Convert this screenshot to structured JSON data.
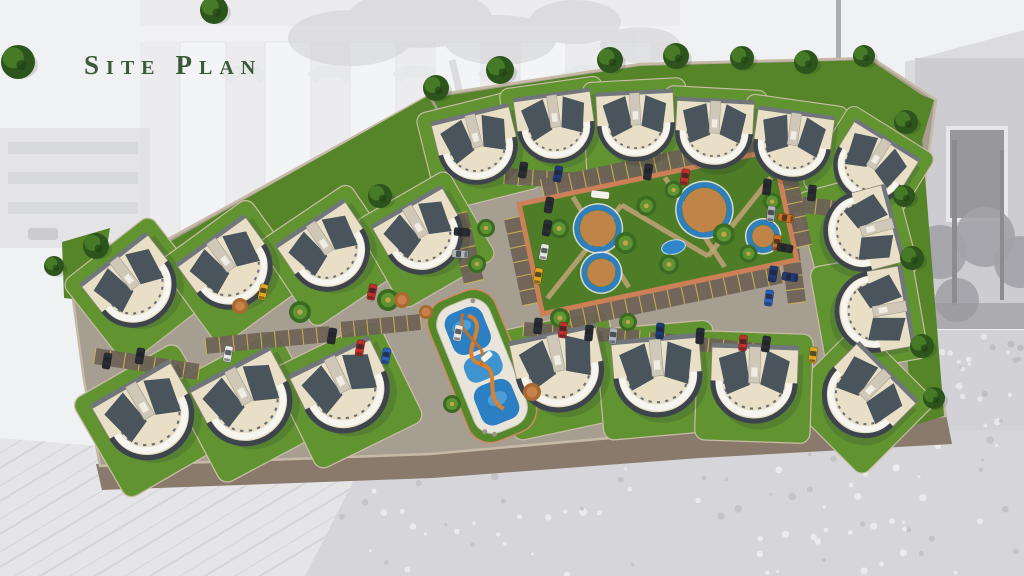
{
  "slide": {
    "title_full": "Site Plan",
    "title_s1": "S",
    "title_s2": "ITE",
    "title_s3": "P",
    "title_s4": "LAN",
    "title_color": "#3b5a39"
  },
  "palette": {
    "pavement": "#a79e92",
    "curb": "#8a7a6c",
    "site_edge": "#c6b9a6",
    "grass": "#558429",
    "grass_pad": "#619331",
    "grass_edge": "#c9bda8",
    "roof_cream": "#e9dfc6",
    "roof_dark": "#4a545c",
    "roof_spine": "#cfc8b8",
    "villa_outline": "#8a8276",
    "front_white": "#f7f5ef",
    "front_dark": "#3d444b",
    "stall": "#6e6156",
    "stall_line": "#d2b855",
    "terracotta": "#cc8057",
    "court_green": "#4f7c27",
    "path_tan": "#c2a377",
    "ring_blue": "#2e7ec2",
    "ring_center": "#c08448",
    "pond_blue": "#2f86c8",
    "pool_blue": "#2b7fc2",
    "pool_blue_light": "#58a5da",
    "deck_white": "#e9e5da",
    "slide_orange": "#d8812f",
    "tree_dark": "#2d541c",
    "tree_light": "#477a27",
    "palm_dark": "#3a6b21",
    "palm_light": "#5d9431",
    "palm_center": "#c9a24e",
    "bush_orange": "#a9692f",
    "bush_orange_light": "#c6824a",
    "car_colors": {
      "red": "#c03028",
      "navy": "#1f3a7a",
      "blue": "#2c5fc0",
      "yellow": "#e0a820",
      "white": "#e8e8e8",
      "dark": "#2a2d33",
      "maroon": "#7c2420",
      "orange": "#cf7020",
      "silver": "#b0b3b8"
    }
  },
  "site": {
    "outline": [
      [
        428,
        96
      ],
      [
        640,
        64
      ],
      [
        872,
        58
      ],
      [
        936,
        100
      ],
      [
        916,
        248
      ],
      [
        946,
        416
      ],
      [
        700,
        430
      ],
      [
        430,
        454
      ],
      [
        100,
        466
      ],
      [
        84,
        380
      ],
      [
        72,
        292
      ]
    ],
    "curb": [
      [
        96,
        464
      ],
      [
        430,
        452
      ],
      [
        700,
        428
      ],
      [
        946,
        414
      ],
      [
        952,
        444
      ],
      [
        700,
        458
      ],
      [
        433,
        478
      ],
      [
        102,
        490
      ]
    ],
    "lawns": [
      [
        [
          846,
          64
        ],
        [
          934,
          100
        ],
        [
          906,
          196
        ],
        [
          850,
          152
        ]
      ],
      [
        [
          894,
          148
        ],
        [
          922,
          138
        ],
        [
          944,
          416
        ],
        [
          912,
          426
        ]
      ],
      [
        [
          62,
          242
        ],
        [
          110,
          228
        ],
        [
          98,
          302
        ],
        [
          64,
          298
        ]
      ],
      [
        [
          428,
          96
        ],
        [
          472,
          172
        ],
        [
          420,
          214
        ],
        [
          330,
          258
        ],
        [
          230,
          292
        ],
        [
          128,
          318
        ],
        [
          74,
          296
        ]
      ],
      [
        [
          432,
          98
        ],
        [
          640,
          66
        ],
        [
          870,
          60
        ],
        [
          932,
          102
        ],
        [
          906,
          170
        ],
        [
          844,
          150
        ],
        [
          700,
          140
        ],
        [
          560,
          148
        ],
        [
          474,
          168
        ]
      ]
    ],
    "villas": [
      [
        478,
        148,
        -14,
        0.95
      ],
      [
        556,
        128,
        -8,
        0.92
      ],
      [
        636,
        126,
        -3,
        0.92
      ],
      [
        714,
        134,
        3,
        0.92
      ],
      [
        792,
        146,
        8,
        0.92
      ],
      [
        870,
        168,
        32,
        0.9
      ],
      [
        860,
        232,
        75,
        0.95
      ],
      [
        872,
        312,
        80,
        0.97
      ],
      [
        862,
        398,
        45,
        1.0
      ],
      [
        560,
        372,
        -12,
        1.05
      ],
      [
        658,
        377,
        -5,
        1.05
      ],
      [
        754,
        384,
        2,
        1.03
      ],
      [
        150,
        418,
        -30,
        1.08
      ],
      [
        248,
        404,
        -28,
        1.08
      ],
      [
        346,
        392,
        -26,
        1.06
      ],
      [
        136,
        288,
        -38,
        1.0
      ],
      [
        232,
        270,
        -36,
        1.0
      ],
      [
        330,
        253,
        -34,
        0.98
      ],
      [
        424,
        237,
        -30,
        0.96
      ]
    ],
    "trees": [
      [
        18,
        62,
        17
      ],
      [
        214,
        10,
        14
      ],
      [
        96,
        246,
        13
      ],
      [
        54,
        266,
        10
      ],
      [
        380,
        196,
        12
      ],
      [
        436,
        88,
        13
      ],
      [
        500,
        70,
        14
      ],
      [
        610,
        60,
        13
      ],
      [
        676,
        56,
        13
      ],
      [
        742,
        58,
        12
      ],
      [
        806,
        62,
        12
      ],
      [
        864,
        56,
        11
      ],
      [
        906,
        122,
        12
      ],
      [
        904,
        196,
        11
      ],
      [
        912,
        258,
        12
      ],
      [
        922,
        346,
        12
      ],
      [
        934,
        398,
        11
      ]
    ],
    "palms": [
      [
        300,
        312,
        11
      ],
      [
        388,
        300,
        11
      ],
      [
        486,
        228,
        9
      ],
      [
        477,
        264,
        9
      ],
      [
        560,
        318,
        10
      ],
      [
        452,
        404,
        9
      ],
      [
        628,
        322,
        9
      ]
    ],
    "bushes": [
      [
        240,
        306,
        8
      ],
      [
        402,
        300,
        8
      ],
      [
        426,
        312,
        7
      ],
      [
        532,
        392,
        9
      ]
    ],
    "cars": [
      [
        523,
        170,
        100,
        "dark"
      ],
      [
        558,
        174,
        100,
        "navy"
      ],
      [
        648,
        172,
        98,
        "dark"
      ],
      [
        685,
        177,
        98,
        "red"
      ],
      [
        812,
        193,
        96,
        "dark"
      ],
      [
        549,
        205,
        100,
        "dark"
      ],
      [
        547,
        228,
        100,
        "dark"
      ],
      [
        544,
        252,
        100,
        "white"
      ],
      [
        538,
        276,
        100,
        "yellow"
      ],
      [
        767,
        187,
        96,
        "dark"
      ],
      [
        771,
        214,
        96,
        "silver"
      ],
      [
        777,
        243,
        98,
        "orange"
      ],
      [
        773,
        274,
        98,
        "navy"
      ],
      [
        769,
        298,
        98,
        "blue"
      ],
      [
        538,
        326,
        96,
        "dark"
      ],
      [
        563,
        330,
        96,
        "red"
      ],
      [
        589,
        333,
        96,
        "dark"
      ],
      [
        613,
        336,
        96,
        "silver"
      ],
      [
        660,
        331,
        95,
        "navy"
      ],
      [
        700,
        336,
        95,
        "dark"
      ],
      [
        743,
        343,
        95,
        "red"
      ],
      [
        228,
        354,
        100,
        "white"
      ],
      [
        332,
        336,
        100,
        "dark"
      ],
      [
        360,
        348,
        100,
        "red"
      ],
      [
        386,
        356,
        100,
        "blue"
      ],
      [
        263,
        292,
        102,
        "yellow"
      ],
      [
        372,
        292,
        102,
        "red"
      ],
      [
        107,
        361,
        100,
        "dark"
      ],
      [
        140,
        356,
        100,
        "dark"
      ],
      [
        458,
        333,
        100,
        "white"
      ],
      [
        462,
        232,
        5,
        "dark"
      ],
      [
        460,
        254,
        5,
        "silver"
      ],
      [
        786,
        218,
        10,
        "orange"
      ],
      [
        785,
        248,
        10,
        "dark"
      ],
      [
        790,
        277,
        8,
        "navy"
      ],
      [
        813,
        355,
        98,
        "yellow"
      ],
      [
        766,
        344,
        98,
        "dark"
      ]
    ],
    "stalls": [
      [
        [
          505,
          168
        ],
        [
          688,
          180
        ],
        16,
        13
      ],
      [
        [
          700,
          184
        ],
        [
          846,
          202
        ],
        16,
        10
      ],
      [
        [
          205,
          338
        ],
        [
          330,
          326
        ],
        16,
        9
      ],
      [
        [
          340,
          322
        ],
        [
          420,
          314
        ],
        16,
        6
      ],
      [
        [
          96,
          348
        ],
        [
          200,
          364
        ],
        16,
        7
      ],
      [
        [
          524,
          322
        ],
        [
          640,
          330
        ],
        14,
        8
      ],
      [
        [
          650,
          332
        ],
        [
          768,
          344
        ],
        14,
        8
      ],
      [
        [
          776,
          210
        ],
        [
          788,
          304
        ],
        -18,
        7
      ],
      [
        [
          448,
          216
        ],
        [
          464,
          284
        ],
        -20,
        4
      ]
    ],
    "courtyard": {
      "cx": 658,
      "cy": 232,
      "rot": -12,
      "w": 260,
      "h": 112,
      "rings": [
        [
          -58,
          -16,
          21
        ],
        [
          -64,
          28,
          17
        ],
        [
          50,
          -12,
          25
        ],
        [
          102,
          26,
          14
        ]
      ],
      "pond": [
        12,
        18,
        12,
        7
      ],
      "paths": [
        [
          [
            -122,
            42
          ],
          [
            -30,
            -34
          ]
        ],
        [
          [
            -30,
            -34
          ],
          [
            44,
            34
          ]
        ],
        [
          [
            44,
            34
          ],
          [
            122,
            -30
          ]
        ],
        [
          [
            -76,
            -52
          ],
          [
            -40,
            48
          ]
        ],
        [
          [
            18,
            -52
          ],
          [
            58,
            48
          ]
        ]
      ],
      "palms": [
        [
          -96,
          -24,
          10
        ],
        [
          -34,
          4,
          11
        ],
        [
          -6,
          -28,
          10
        ],
        [
          24,
          -38,
          9
        ],
        [
          4,
          34,
          10
        ],
        [
          64,
          16,
          11
        ],
        [
          118,
          -6,
          9
        ],
        [
          84,
          40,
          9
        ]
      ],
      "stalls": [
        [
          [
            -104,
            -58
          ],
          [
            112,
            -58
          ],
          -18,
          15
        ],
        [
          [
            -104,
            58
          ],
          [
            112,
            58
          ],
          18,
          15
        ],
        [
          [
            -130,
            -44
          ],
          [
            -130,
            44
          ],
          18,
          6
        ],
        [
          [
            130,
            -44
          ],
          [
            130,
            44
          ],
          -18,
          6
        ]
      ]
    },
    "pool": {
      "cx": 482,
      "cy": 366,
      "rot": -22
    }
  },
  "background": {
    "style": "faded-grayscale-photo",
    "elements": [
      "colonnade-arches",
      "palm-tree",
      "left-building",
      "right-house-window",
      "dark-trees",
      "flower-meadow",
      "paved-tiles"
    ]
  }
}
